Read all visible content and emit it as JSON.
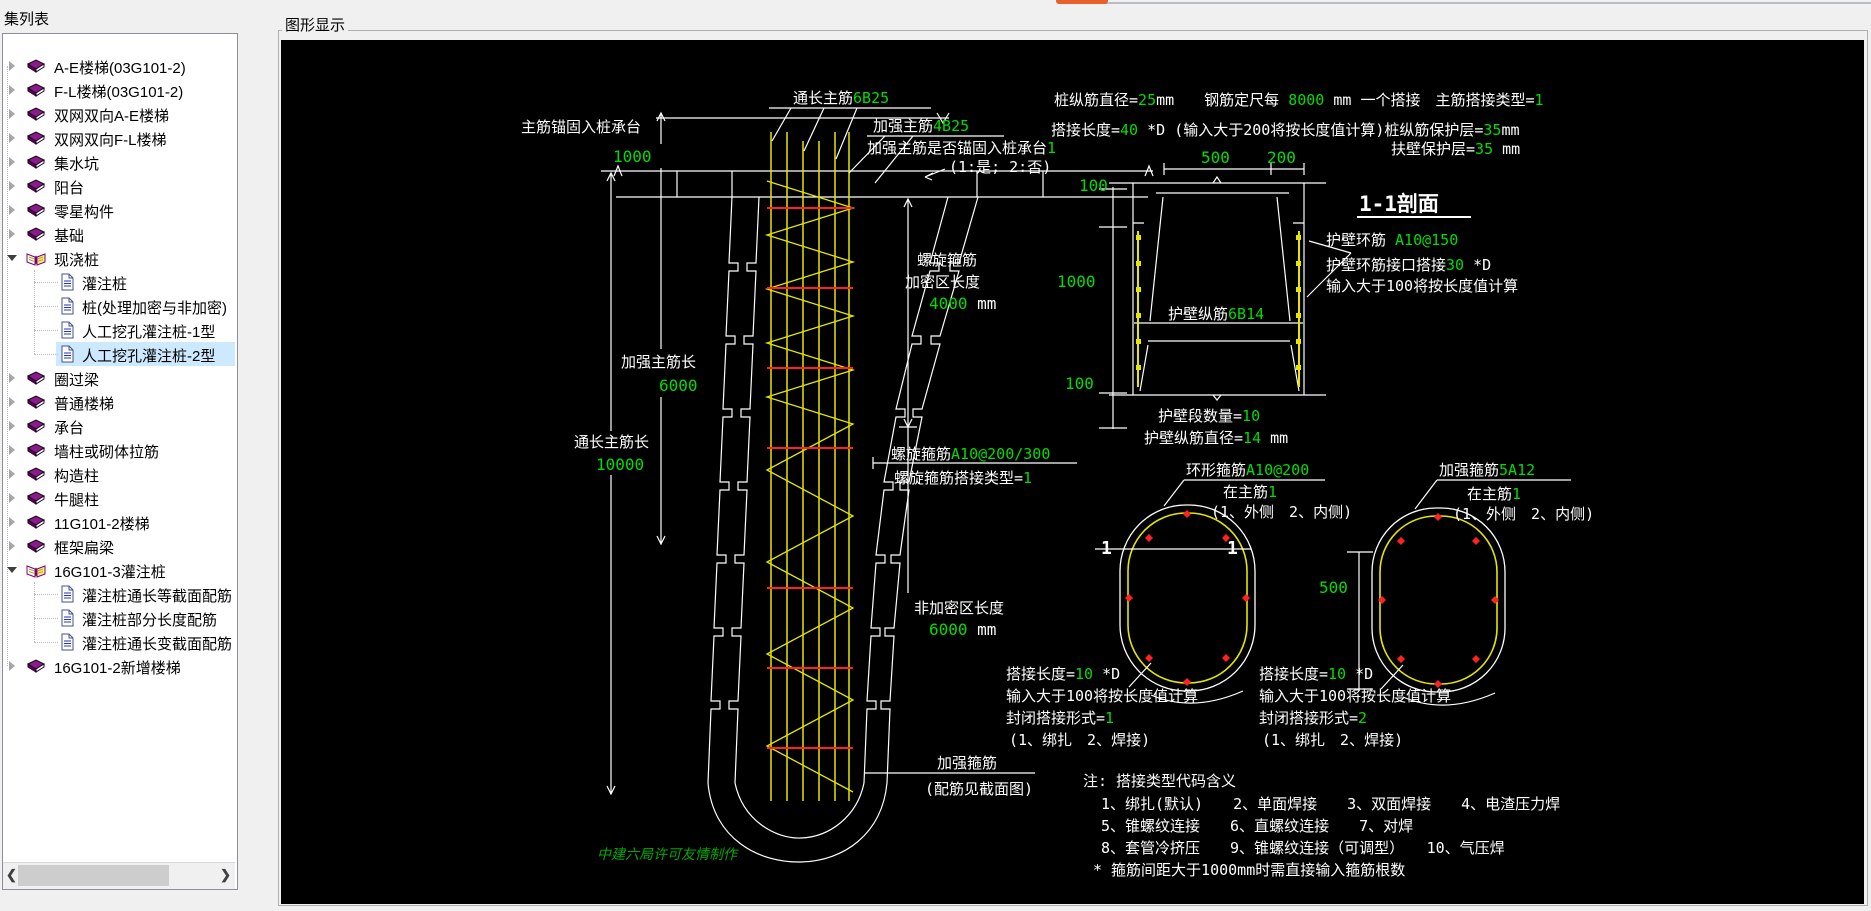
{
  "shell": {
    "accent_color": "#e8612c"
  },
  "sidebar": {
    "title": "集列表",
    "scrollbar": {
      "left_arrow": "❮",
      "right_arrow": "❯"
    },
    "items": [
      {
        "label": "A-E楼梯(03G101-2)",
        "icon": "book",
        "chevron": "right",
        "level": 0
      },
      {
        "label": "F-L楼梯(03G101-2)",
        "icon": "book",
        "chevron": "right",
        "level": 0
      },
      {
        "label": "双网双向A-E楼梯",
        "icon": "book",
        "chevron": "right",
        "level": 0
      },
      {
        "label": "双网双向F-L楼梯",
        "icon": "book",
        "chevron": "right",
        "level": 0
      },
      {
        "label": "集水坑",
        "icon": "book",
        "chevron": "right",
        "level": 0
      },
      {
        "label": "阳台",
        "icon": "book",
        "chevron": "right",
        "level": 0
      },
      {
        "label": "零星构件",
        "icon": "book",
        "chevron": "right",
        "level": 0
      },
      {
        "label": "基础",
        "icon": "book",
        "chevron": "right",
        "level": 0
      },
      {
        "label": "现浇桩",
        "icon": "book-open",
        "chevron": "down",
        "level": 0
      },
      {
        "label": "灌注桩",
        "icon": "doc",
        "level": 1
      },
      {
        "label": "桩(处理加密与非加密)",
        "icon": "doc",
        "level": 1
      },
      {
        "label": "人工挖孔灌注桩-1型",
        "icon": "doc",
        "level": 1
      },
      {
        "label": "人工挖孔灌注桩-2型",
        "icon": "doc",
        "level": 1,
        "selected": true
      },
      {
        "label": "圈过梁",
        "icon": "book",
        "chevron": "right",
        "level": 0
      },
      {
        "label": "普通楼梯",
        "icon": "book",
        "chevron": "right",
        "level": 0
      },
      {
        "label": "承台",
        "icon": "book",
        "chevron": "right",
        "level": 0
      },
      {
        "label": "墙柱或砌体拉筋",
        "icon": "book",
        "chevron": "right",
        "level": 0
      },
      {
        "label": "构造柱",
        "icon": "book",
        "chevron": "right",
        "level": 0
      },
      {
        "label": "牛腿柱",
        "icon": "book",
        "chevron": "right",
        "level": 0
      },
      {
        "label": "11G101-2楼梯",
        "icon": "book",
        "chevron": "right",
        "level": 0
      },
      {
        "label": "框架扁梁",
        "icon": "book",
        "chevron": "right",
        "level": 0
      },
      {
        "label": "16G101-3灌注桩",
        "icon": "book-open",
        "chevron": "down",
        "level": 0
      },
      {
        "label": "灌注桩通长等截面配筋",
        "icon": "doc",
        "level": 1
      },
      {
        "label": "灌注桩部分长度配筋",
        "icon": "doc",
        "level": 1
      },
      {
        "label": "灌注桩通长变截面配筋",
        "icon": "doc",
        "level": 1
      },
      {
        "label": "16G101-2新增楼梯",
        "icon": "book",
        "chevron": "right",
        "level": 0
      }
    ]
  },
  "viewer": {
    "title": "图形显示",
    "background": "#000000"
  },
  "colors": {
    "cad_white": "#ffffff",
    "cad_green": "#00dd00",
    "rebar_yellow": "#e6e600",
    "stirrup_red": "#ff2222",
    "watermark_green": "#00aa00"
  },
  "drawing": {
    "main_bars": [
      [
        "通长主筋",
        "w"
      ],
      [
        "6B25",
        "g"
      ]
    ],
    "extra_bars": [
      [
        "加强主筋",
        "w"
      ],
      [
        "4B25",
        "g"
      ]
    ],
    "anchor_flag": [
      [
        "加强主筋是否锚固入桩承台",
        "w"
      ],
      [
        "1",
        "g"
      ]
    ],
    "anchor_opts": [
      [
        "(1:是; 2:否)",
        "w"
      ]
    ],
    "anchor_len_label": [
      [
        "主筋锚固入桩承台",
        "w"
      ]
    ],
    "anchor_len_val": [
      [
        "1000",
        "g"
      ]
    ],
    "param_line1": [
      [
        "桩纵筋直径=",
        "w"
      ],
      [
        "25",
        "g"
      ],
      [
        "mm",
        "w"
      ],
      [
        "　　钢筋定尺每 ",
        "w"
      ],
      [
        "8000",
        "g"
      ],
      [
        " mm 一个搭接　主筋搭接类型=",
        "w"
      ],
      [
        "1",
        "g"
      ]
    ],
    "param_line2": [
      [
        "搭接长度=",
        "w"
      ],
      [
        "40",
        "g"
      ],
      [
        "  *D (输入大于200将按长度值计算)桩纵筋保护层=",
        "w"
      ],
      [
        "35",
        "g"
      ],
      [
        "mm",
        "w"
      ]
    ],
    "param_buttress": [
      [
        "扶壁保护层=",
        "w"
      ],
      [
        "35",
        "g"
      ],
      [
        " mm",
        "w"
      ]
    ],
    "dim_500": [
      [
        "500",
        "g"
      ]
    ],
    "dim_200": [
      [
        "200",
        "g"
      ]
    ],
    "dim_100_top": [
      [
        "100",
        "g"
      ]
    ],
    "dim_1000": [
      [
        "1000",
        "g"
      ]
    ],
    "dim_100_bottom": [
      [
        "100",
        "g"
      ]
    ],
    "section_title": [
      [
        "1-1剖面",
        "w"
      ]
    ],
    "wall_hoop": [
      [
        "护壁环筋 ",
        "w"
      ],
      [
        "A10@150",
        "g"
      ]
    ],
    "wall_hoop_lap": [
      [
        "护壁环筋接口搭接",
        "w"
      ],
      [
        "30",
        "g"
      ],
      [
        " *D",
        "w"
      ]
    ],
    "wall_hoop_note": [
      [
        "输入大于100将按长度值计算",
        "w"
      ]
    ],
    "wall_vbars": [
      [
        "护壁纵筋",
        "w"
      ],
      [
        "6B14",
        "g"
      ]
    ],
    "wall_count": [
      [
        "护壁段数量=",
        "w"
      ],
      [
        "10",
        "g"
      ]
    ],
    "wall_dia": [
      [
        "护壁纵筋直径=",
        "w"
      ],
      [
        "14",
        "g"
      ],
      [
        " mm",
        "w"
      ]
    ],
    "spiral_label": [
      [
        "螺旋箍筋",
        "w"
      ]
    ],
    "dense_label": [
      [
        "加密区长度",
        "w"
      ]
    ],
    "dense_val": [
      [
        "4000",
        "g"
      ],
      [
        " mm",
        "w"
      ]
    ],
    "extra_len_label": [
      [
        "加强主筋长",
        "w"
      ]
    ],
    "extra_len_val": [
      [
        "6000",
        "g"
      ]
    ],
    "main_len_label": [
      [
        "通长主筋长",
        "w"
      ]
    ],
    "main_len_val": [
      [
        "10000",
        "g"
      ]
    ],
    "spiral_spec": [
      [
        "螺旋箍筋",
        "w"
      ],
      [
        "A10@200/300",
        "g"
      ]
    ],
    "spiral_lap": [
      [
        "螺旋箍筋搭接类型=",
        "w"
      ],
      [
        "1",
        "g"
      ]
    ],
    "sparse_label": [
      [
        "非加密区长度",
        "w"
      ]
    ],
    "sparse_val": [
      [
        "6000",
        "g"
      ],
      [
        " mm",
        "w"
      ]
    ],
    "lap_left_1": [
      [
        "搭接长度=",
        "w"
      ],
      [
        "10",
        "g"
      ],
      [
        " *D",
        "w"
      ]
    ],
    "lap_left_2": [
      [
        "输入大于100将按长度值计算",
        "w"
      ]
    ],
    "lap_left_3": [
      [
        "封闭搭接形式=",
        "w"
      ],
      [
        "1",
        "g"
      ]
    ],
    "lap_left_4": [
      [
        "(1、绑扎　2、焊接)",
        "w"
      ]
    ],
    "lap_right_1": [
      [
        "搭接长度=",
        "w"
      ],
      [
        "10",
        "g"
      ],
      [
        " *D",
        "w"
      ]
    ],
    "lap_right_2": [
      [
        "输入大于100将按长度值计算",
        "w"
      ]
    ],
    "lap_right_3": [
      [
        "封闭搭接形式=",
        "w"
      ],
      [
        "2",
        "g"
      ]
    ],
    "lap_right_4": [
      [
        "(1、绑扎　2、焊接)",
        "w"
      ]
    ],
    "bottom_hoop": [
      [
        "加强箍筋",
        "w"
      ]
    ],
    "bottom_hoop_note": [
      [
        "(配筋见截面图)",
        "w"
      ]
    ],
    "ring_label": [
      [
        "环形箍筋",
        "w"
      ],
      [
        "A10@200",
        "g"
      ]
    ],
    "ring_pos": [
      [
        "在主筋",
        "w"
      ],
      [
        "1",
        "g"
      ]
    ],
    "ring_opts": [
      [
        "(1、外侧　2、内侧)",
        "w"
      ]
    ],
    "str_label": [
      [
        "加强箍筋",
        "w"
      ],
      [
        "5A12",
        "g"
      ]
    ],
    "str_pos": [
      [
        "在主筋",
        "w"
      ],
      [
        "1",
        "g"
      ]
    ],
    "str_opts": [
      [
        "(1、外侧　2、内侧)",
        "w"
      ]
    ],
    "sec_mark_left": [
      [
        "1",
        "w"
      ]
    ],
    "sec_mark_right": [
      [
        "1",
        "w"
      ]
    ],
    "dim_oval_500": [
      [
        "500",
        "g"
      ]
    ],
    "note_0": [
      [
        "注: 搭接类型代码含义",
        "w"
      ]
    ],
    "note_1": [
      [
        "1、绑扎(默认)　　2、单面焊接　　3、双面焊接　　4、电渣压力焊",
        "w"
      ]
    ],
    "note_2": [
      [
        "5、锥螺纹连接　　6、直螺纹连接　　7、对焊",
        "w"
      ]
    ],
    "note_3": [
      [
        "8、套管冷挤压　　9、锥螺纹连接（可调型）　　10、气压焊",
        "w"
      ]
    ],
    "note_4": [
      [
        "* 箍筋间距大于1000mm时需直接输入箍筋根数",
        "w"
      ]
    ],
    "watermark": [
      [
        "中建六局许可友情制作",
        "m"
      ]
    ]
  }
}
